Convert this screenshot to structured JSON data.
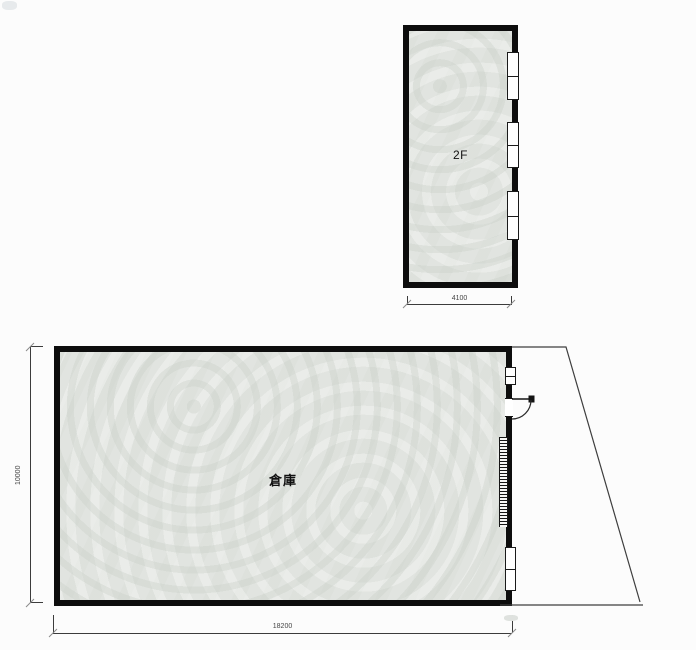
{
  "floor2": {
    "label": "2F",
    "width_dim": "4100"
  },
  "floor1": {
    "label": "倉庫",
    "width_dim": "18200",
    "height_dim": "10000"
  },
  "colors": {
    "wall": "#0d0d0d",
    "floor_fill": "#e1e4e0",
    "dimension_line": "#3c3c3c",
    "dimension_text": "#454545",
    "background": "#fcfcfc"
  }
}
